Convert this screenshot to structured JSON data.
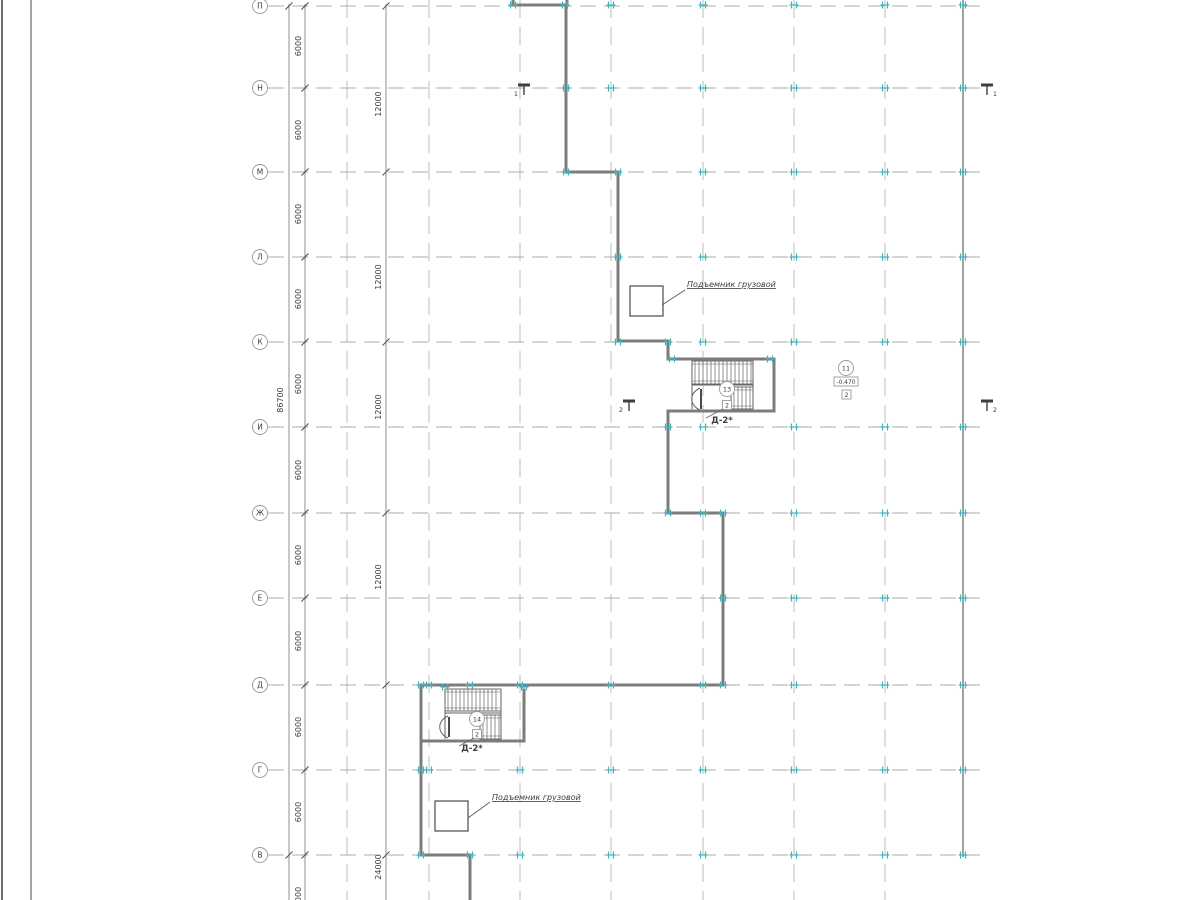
{
  "colors": {
    "wall": "#7c7c7c",
    "wall_dark": "#5a5a5a",
    "grid_v": "#bdbdbd",
    "grid_h": "#ababab",
    "dim_line": "#8f8f8f",
    "text": "#3c3c3c",
    "tick": "#3fb3c3",
    "marker_stroke": "#9a9a9a",
    "frame": "#4a4a4a",
    "stair": "#606060"
  },
  "sheet": {
    "frame_lines_x": [
      2,
      31
    ]
  },
  "axes": {
    "circle_x": 260,
    "radius": 7.5,
    "line_x_start": 268,
    "line_x_end": 986,
    "items": [
      {
        "label": "П",
        "y": 6
      },
      {
        "label": "Н",
        "y": 88
      },
      {
        "label": "М",
        "y": 172
      },
      {
        "label": "Л",
        "y": 257
      },
      {
        "label": "К",
        "y": 342
      },
      {
        "label": "И",
        "y": 427
      },
      {
        "label": "Ж",
        "y": 513
      },
      {
        "label": "Е",
        "y": 598
      },
      {
        "label": "Д",
        "y": 685
      },
      {
        "label": "Г",
        "y": 770
      },
      {
        "label": "В",
        "y": 855
      }
    ]
  },
  "columns": {
    "xs": [
      347,
      429,
      520,
      611,
      703,
      794,
      885
    ],
    "right_wall_x": 963
  },
  "dimensions": {
    "total": {
      "line_x": 289,
      "label": "86700",
      "label_x": 283,
      "label_y": 400,
      "tick_ys": [
        6,
        855
      ]
    },
    "increment": {
      "line_x": 305,
      "label_x": 301,
      "labels": [
        {
          "text": "6000",
          "y": 46
        },
        {
          "text": "6000",
          "y": 130
        },
        {
          "text": "6000",
          "y": 214
        },
        {
          "text": "6000",
          "y": 299
        },
        {
          "text": "6000",
          "y": 384
        },
        {
          "text": "6000",
          "y": 470
        },
        {
          "text": "6000",
          "y": 555
        },
        {
          "text": "6000",
          "y": 641
        },
        {
          "text": "6000",
          "y": 727
        },
        {
          "text": "6000",
          "y": 812
        },
        {
          "text": "6000",
          "y": 897
        }
      ],
      "tick_ys": [
        6,
        88,
        172,
        257,
        342,
        427,
        513,
        598,
        685,
        770,
        855
      ]
    },
    "double": {
      "line_x": 386,
      "label_x": 381,
      "labels": [
        {
          "text": "12000",
          "y": 104
        },
        {
          "text": "12000",
          "y": 277
        },
        {
          "text": "12000",
          "y": 407
        },
        {
          "text": "12000",
          "y": 577
        },
        {
          "text": "24000",
          "y": 867
        }
      ],
      "tick_ys": [
        6,
        172,
        342,
        513,
        685,
        855
      ]
    }
  },
  "building": {
    "wall_width": 3,
    "walls": [
      [
        513,
        0,
        513,
        5
      ],
      [
        567,
        0,
        567,
        5
      ],
      [
        513,
        5,
        567,
        5
      ],
      [
        566,
        5,
        566,
        172
      ],
      [
        566,
        172,
        618,
        172
      ],
      [
        618,
        172,
        618,
        341
      ],
      [
        618,
        341,
        668,
        341
      ],
      [
        668,
        341,
        668,
        359
      ],
      [
        668,
        359,
        774,
        359
      ],
      [
        774,
        359,
        774,
        411
      ],
      [
        774,
        411,
        668,
        411
      ],
      [
        668,
        411,
        668,
        513
      ],
      [
        668,
        513,
        723,
        513
      ],
      [
        723,
        513,
        723,
        685
      ],
      [
        723,
        685,
        421,
        685
      ],
      [
        421,
        685,
        421,
        855
      ],
      [
        421,
        855,
        470,
        855
      ],
      [
        470,
        855,
        470,
        900
      ],
      [
        524,
        690,
        524,
        741
      ],
      [
        421,
        741,
        524,
        741
      ]
    ],
    "right_wall": [
      963,
      0,
      963,
      857
    ]
  },
  "stairs": [
    {
      "label": "Д-2*",
      "flightA": [
        692,
        361,
        753,
        384
      ],
      "flightB": [
        731,
        387,
        753,
        409
      ],
      "extra_lines": [
        [
          692,
          385,
          753,
          385
        ],
        [
          692,
          361,
          692,
          409
        ],
        [
          753,
          361,
          753,
          409
        ],
        [
          731,
          387,
          731,
          409
        ]
      ],
      "door_path": "M 700,388 C 689,393 689,405 700,410",
      "door_leaf": [
        701,
        389,
        701,
        409
      ],
      "circle_text": "13",
      "circle_cx": 727,
      "circle_cy": 389,
      "square_text": "2",
      "square_cx": 727,
      "square_cy": 405,
      "label_x": 722,
      "label_y": 423,
      "leader": [
        723,
        409,
        706,
        418
      ]
    },
    {
      "label": "Д-2*",
      "flightA": [
        445,
        689,
        501,
        711
      ],
      "flightB": [
        480,
        715,
        501,
        739
      ],
      "extra_lines": [
        [
          445,
          713,
          501,
          713
        ],
        [
          445,
          689,
          445,
          739
        ],
        [
          501,
          689,
          501,
          739
        ],
        [
          480,
          715,
          480,
          739
        ]
      ],
      "door_path": "M 448,716 C 437,721 437,733 448,738",
      "door_leaf": [
        449,
        717,
        449,
        737
      ],
      "circle_text": "14",
      "circle_cx": 477,
      "circle_cy": 719,
      "square_text": "2",
      "square_cx": 477,
      "square_cy": 734,
      "label_x": 472,
      "label_y": 751,
      "leader": [
        474,
        738,
        459,
        746
      ]
    }
  ],
  "lifts": [
    {
      "label": "Подъемник грузовой",
      "box": [
        630,
        286,
        33,
        30
      ],
      "label_x": 687,
      "label_y": 287,
      "leader": [
        685,
        290,
        662,
        305
      ]
    },
    {
      "label": "Подъемник грузовой",
      "box": [
        435,
        801,
        33,
        30
      ],
      "label_x": 492,
      "label_y": 800,
      "leader": [
        490,
        802,
        468,
        818
      ]
    }
  ],
  "room_marker": {
    "circle_text": "11",
    "circle_cx": 846,
    "circle_cy": 368,
    "elevation_text": "-0.470",
    "elev_box": [
      834,
      377,
      24,
      9
    ],
    "square_text": "2",
    "square_box": [
      842,
      390,
      9,
      9
    ]
  },
  "section_marks": [
    {
      "num": "1",
      "x": 524,
      "y": 88,
      "side": "left"
    },
    {
      "num": "1",
      "x": 987,
      "y": 88,
      "side": "right"
    },
    {
      "num": "2",
      "x": 629,
      "y": 404,
      "side": "left"
    },
    {
      "num": "2",
      "x": 987,
      "y": 404,
      "side": "right"
    }
  ],
  "ticks": [
    {
      "y": 5,
      "xs": [
        513,
        565,
        611,
        703,
        794,
        885,
        963
      ]
    },
    {
      "y": 88,
      "xs": [
        566,
        611,
        703,
        794,
        885,
        963
      ]
    },
    {
      "y": 172,
      "xs": [
        566,
        618,
        703,
        794,
        885,
        963
      ]
    },
    {
      "y": 257,
      "xs": [
        618,
        703,
        794,
        885,
        963
      ]
    },
    {
      "y": 342,
      "xs": [
        618,
        668,
        703,
        794,
        885,
        963
      ]
    },
    {
      "y": 427,
      "xs": [
        668,
        703,
        794,
        885,
        963
      ]
    },
    {
      "y": 513,
      "xs": [
        668,
        703,
        723,
        794,
        885,
        963
      ]
    },
    {
      "y": 598,
      "xs": [
        723,
        794,
        885,
        963
      ]
    },
    {
      "y": 685,
      "xs": [
        421,
        429,
        470,
        520,
        611,
        703,
        723,
        794,
        885,
        963
      ]
    },
    {
      "y": 770,
      "xs": [
        421,
        429,
        520,
        611,
        703,
        794,
        885,
        963
      ]
    },
    {
      "y": 855,
      "xs": [
        421,
        470,
        520,
        611,
        703,
        794,
        885,
        963
      ]
    },
    {
      "y": 359,
      "xs": [
        672,
        770
      ]
    },
    {
      "y": 687,
      "xs": [
        445,
        524
      ]
    }
  ]
}
